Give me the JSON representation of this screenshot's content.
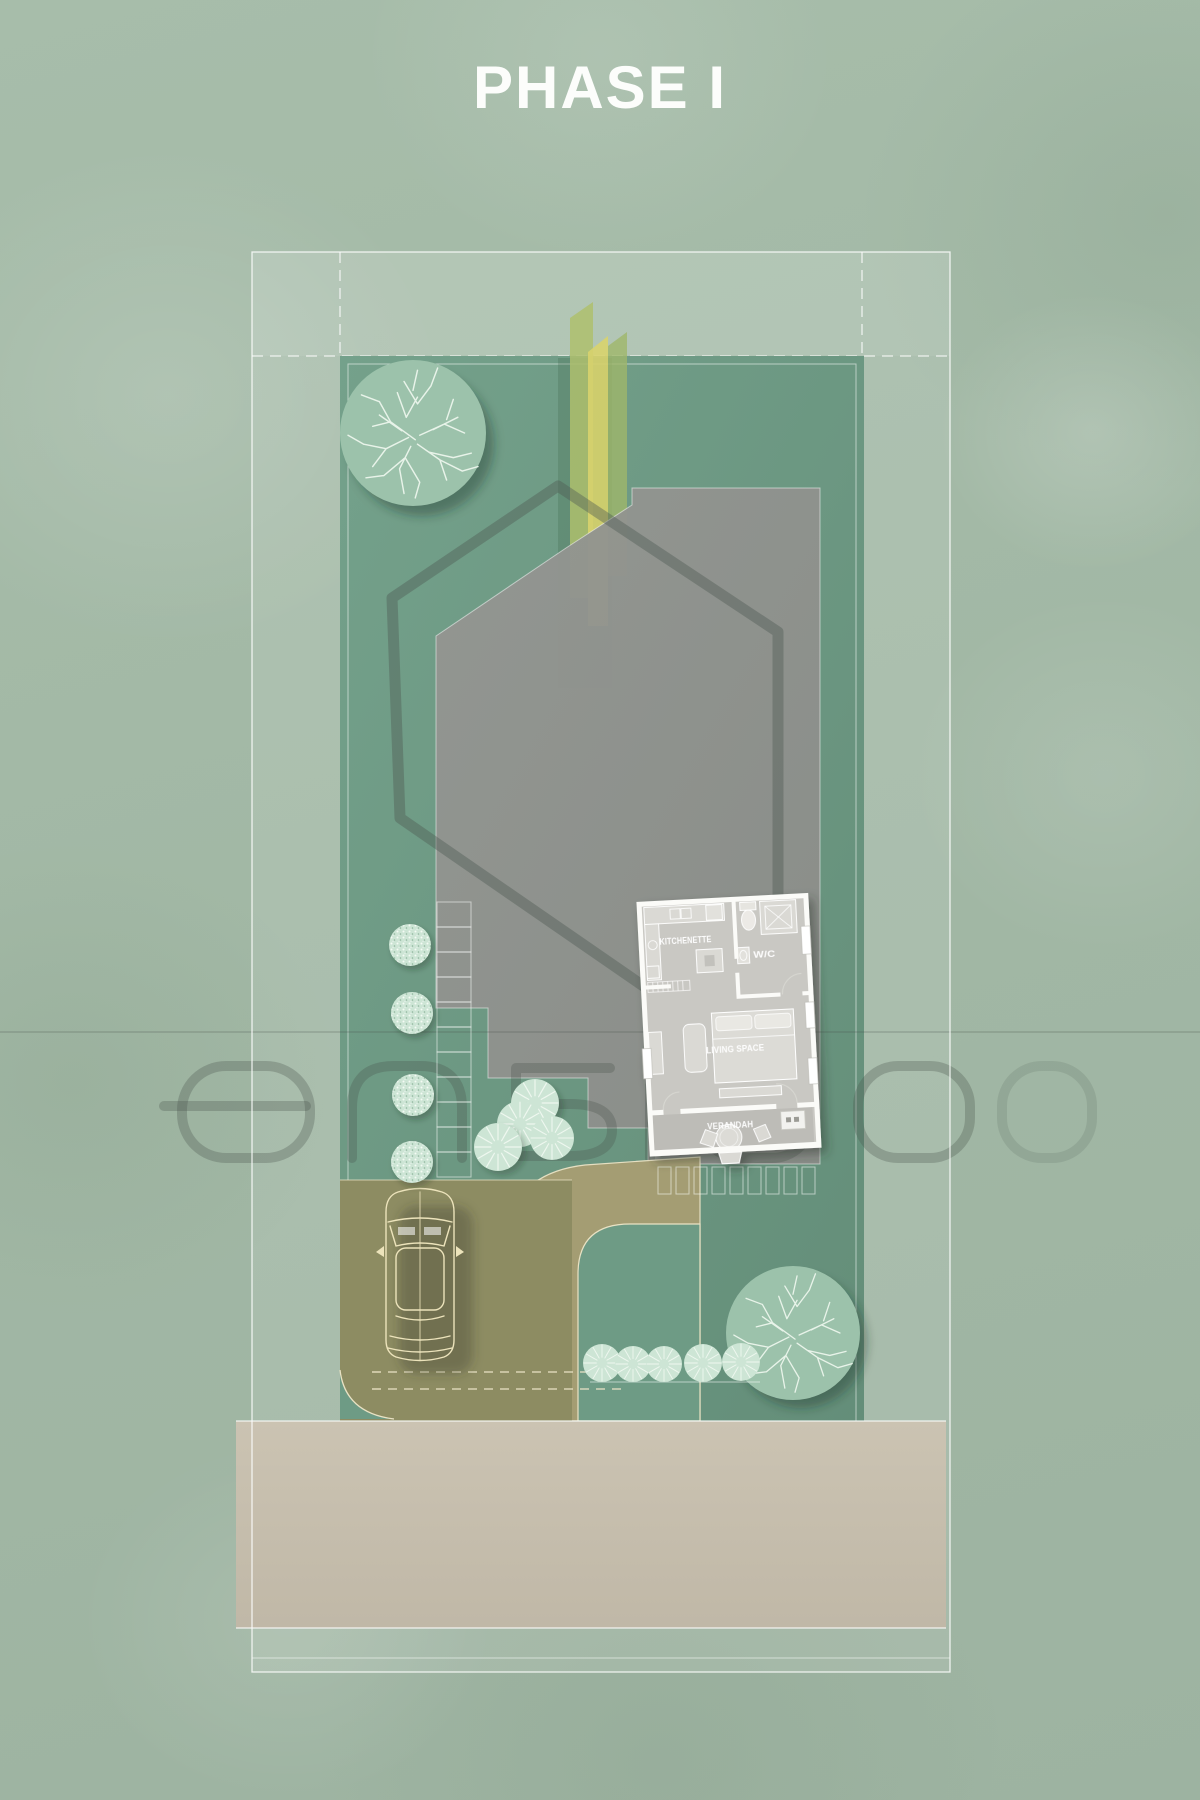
{
  "header": {
    "title": "PHASE I"
  },
  "plan": {
    "room_labels": {
      "kitchenette": "KITCHENETTE",
      "wc": "W/C",
      "living": "LIVING SPACE",
      "verandah": "VERANDAH"
    }
  },
  "watermark": {
    "text": "ensigo"
  },
  "palette": {
    "background": "#a3b9a6",
    "lawn": "#6e9b85",
    "concrete_pad": "#90928e",
    "hexagon_outline": "#4f5a53",
    "driveway": "#8d8c62",
    "walkway": "#a69e73",
    "road": "#c6bead",
    "cream_outline": "#e9e2c4",
    "boundary_line": "#ffffff",
    "title_color": "#fcfdfb",
    "tree_fill": "#9cc2ab",
    "shrub_fill": "#cde5d5",
    "bamboo_yellow": "#d8d36d",
    "bamboo_green": "#aebf6d"
  },
  "features": {
    "large_trees": 2,
    "stipple_shrubs": 4,
    "radial_shrubs": 9,
    "path_steps": 11,
    "parking_pavers": 9,
    "vehicle": "car-top-view"
  }
}
